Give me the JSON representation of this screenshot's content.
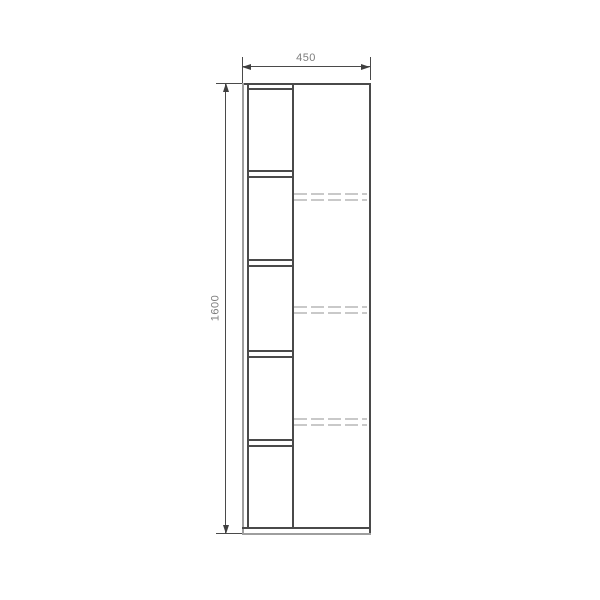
{
  "drawing": {
    "type": "furniture-elevation",
    "description": "Front elevation of a tall cabinet: open shelf column on the left, door panel on the right with hidden shelves shown dashed",
    "dimensions": {
      "width": {
        "label": "450",
        "orientation": "horizontal"
      },
      "height": {
        "label": "1600",
        "orientation": "vertical"
      }
    },
    "colors": {
      "outline": "#4a4a4a",
      "light_edge": "#9e9e9e",
      "hidden_line": "#c9c9c9",
      "dimension_text": "#7d7d7d",
      "background": "#ffffff"
    },
    "geometry": {
      "cabinet_box": {
        "x": 242,
        "y": 83,
        "w": 127,
        "h": 450
      },
      "left_panel_inner_x": 247,
      "divider_x": 292,
      "top_inner_y": 88,
      "bottom_inner_y": 527,
      "open_shelves_y": [
        170,
        259,
        350,
        439
      ],
      "shelf_pair_gap": 6,
      "hidden_shelves_y": [
        193,
        306,
        418
      ],
      "hidden_pair_gap": 6,
      "open_compartment_count": 5,
      "hidden_shelf_count": 3,
      "dim_top": {
        "line_y": 66,
        "ext_top_y": 57,
        "label_x": 306,
        "label_y": 64
      },
      "dim_left": {
        "line_x": 225,
        "ext_left_x": 216,
        "label_x": 216,
        "label_y": 308
      }
    }
  }
}
